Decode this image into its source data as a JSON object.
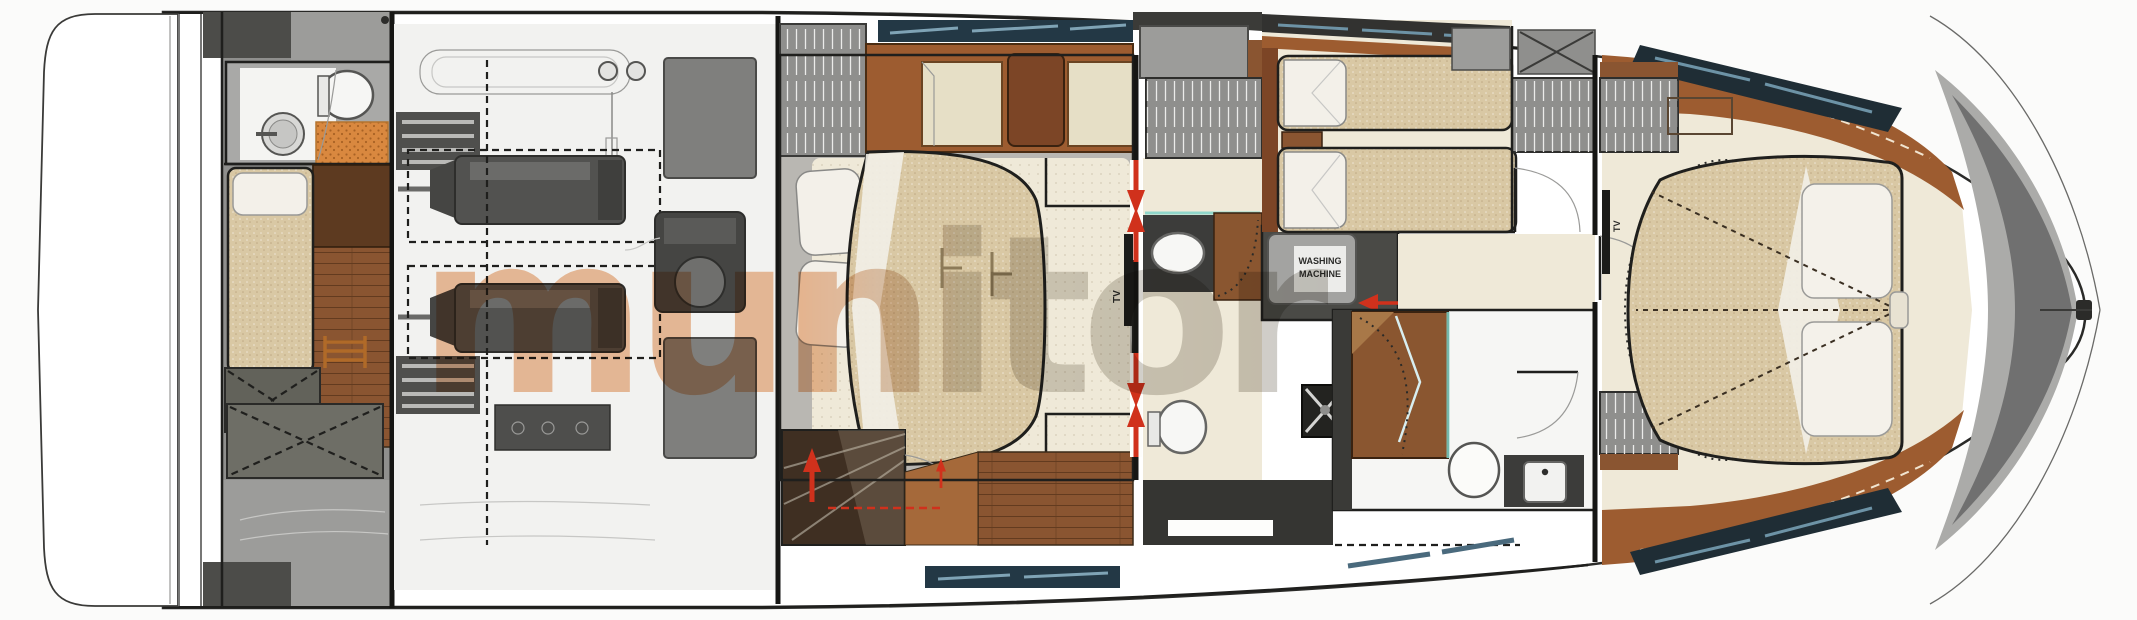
{
  "plan": {
    "labels": {
      "washing_machine_line1": "WASHING",
      "washing_machine_line2": "MACHINE",
      "master_tv": "TV",
      "vip_tv": "TV"
    },
    "watermark_text": "munitor",
    "colors": {
      "accent_red": "#d0311c",
      "wood_brown": "#9d5c30",
      "dark_wood": "#7c4526",
      "floor_cream": "#efe9d8",
      "bed_tan": "#d9c8a4",
      "charcoal": "#3b3b38",
      "deck_gray": "#9c9c9a",
      "engine_gray": "#525250",
      "window_blue": "#233845",
      "glass_teal": "#7fd2c8",
      "watermark_orange": "#e2813b",
      "watermark_gray": "#9d988f"
    },
    "icons": {
      "red-arrow": "triangle-arrow",
      "door-swing": "quarter-arc",
      "ladder": "rung-lines",
      "hanger-rail": "vertical-strokes",
      "storage-brace": "dashed-x"
    }
  }
}
